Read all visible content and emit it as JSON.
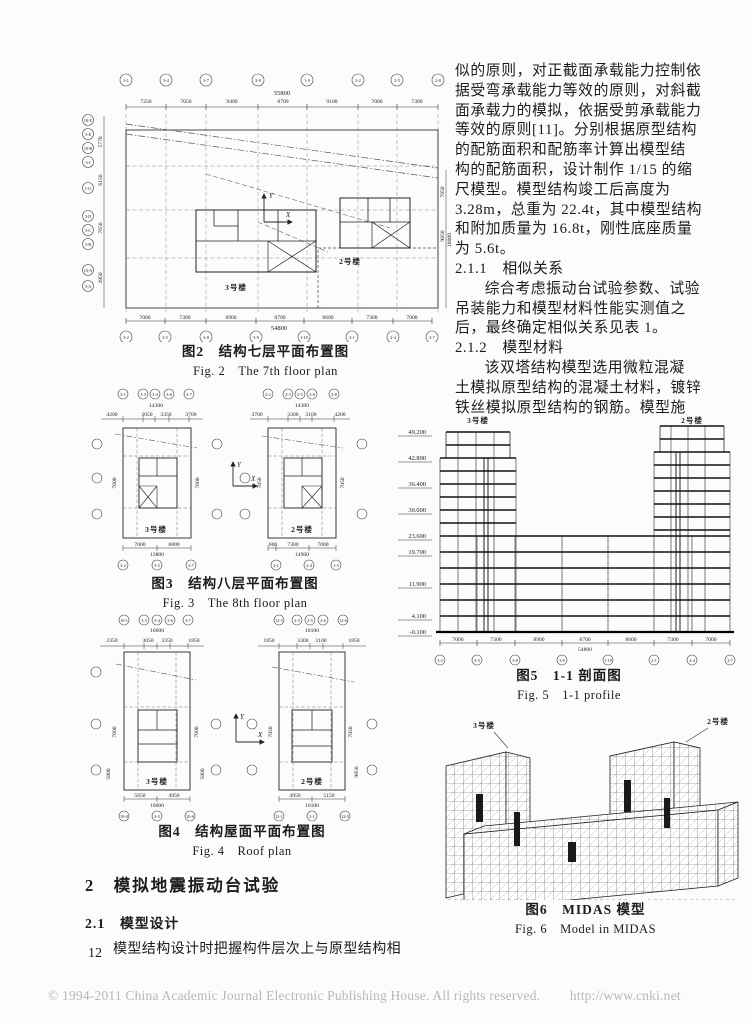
{
  "page": {
    "number": "12",
    "footer_text": "© 1994-2011 China Academic Journal Electronic Publishing House. All rights reserved.",
    "footer_url": "http://www.cnki.net"
  },
  "right_col": {
    "p1": [
      "似的原则，对正截面承载能力控制依",
      "据受弯承载能力等效的原则，对斜截",
      "面承载力的模拟，依据受剪承载能力",
      "等效的原则[11]。分别根据原型结构",
      "的配筋面积和配筋率计算出模型结",
      "构的配筋面积，设计制作 1/15 的缩",
      "尺模型。模型结构竣工后高度为",
      "3.28m，总重为 22.4t，其中模型结构",
      "和附加质量为 16.8t，刚性底座质量",
      "为 5.6t。"
    ],
    "h211": "2.1.1　相似关系",
    "p2": [
      "综合考虑振动台试验参数、试验",
      "吊装能力和模型材料性能实测值之",
      "后，最终确定相似关系见表 1。"
    ],
    "h212": "2.1.2　模型材料",
    "p3": [
      "该双塔结构模型选用微粒混凝",
      "土模拟原型结构的混凝土材料，镀锌",
      "铁丝模拟原型结构的钢筋。模型施"
    ]
  },
  "left_col": {
    "h2": "2　模拟地震振动台试验",
    "h21": "2.1　模型设计",
    "p1": "模型结构设计时把握构件层次上与原型结构相"
  },
  "fig2": {
    "caption_zh": "图2　结构七层平面布置图",
    "caption_en": "Fig. 2　The 7th floor plan",
    "top_total": "55800",
    "top_dims": [
      "7250",
      "7050",
      "9400",
      "8700",
      "9100",
      "7000",
      "7300"
    ],
    "bottom_dims": [
      "7000",
      "7300",
      "8900",
      "8700",
      "8600",
      "7300",
      "7000"
    ],
    "bottom_total": "54800",
    "top_bubbles": [
      "3-1",
      "3-4",
      "3-7",
      "3-8",
      "1-9",
      "2-2",
      "2-5",
      "2-8"
    ],
    "bottom_bubbles": [
      "3-2",
      "3-5",
      "3-8",
      "3-9",
      "1-10",
      "2-1",
      "2-4",
      "2-7"
    ],
    "left_bubbles": [
      "10-E",
      "3-E",
      "10-B",
      "3-J",
      "1-G",
      "3-D",
      "3-C",
      "3-B",
      "10-A",
      "3-A"
    ],
    "left_dims": [
      "5770",
      "6150",
      "7650",
      "3950"
    ],
    "right_dims": [
      "7050",
      "9850",
      "18000"
    ],
    "tower3": "3号楼",
    "tower2": "2号楼",
    "axis_x": "X",
    "axis_y": "Y"
  },
  "fig3": {
    "caption_zh": "图3　结构八层平面布置图",
    "caption_en": "Fig. 3　The 8th floor plan",
    "left": {
      "total": "14300",
      "dims": [
        "4200",
        "3050",
        "3350",
        "3700"
      ],
      "side": "7600",
      "bottom": [
        "7000",
        "6800"
      ],
      "bottom_total": "13800",
      "label": "3号楼",
      "bubbles": [
        "3-1",
        "3-3",
        "3-4",
        "3-6",
        "3-7"
      ],
      "bottom_bubbles": [
        "3-2",
        "3-5",
        "3-7"
      ]
    },
    "right": {
      "total": "14300",
      "dims": [
        "3700",
        "3300",
        "3100",
        "4200"
      ],
      "side": "7050",
      "bottom": [
        "600",
        "7300",
        "7000"
      ],
      "bottom_total": "14900",
      "label": "2号楼",
      "bubbles": [
        "2-2",
        "2-3",
        "2-5",
        "2-6",
        "2-8"
      ],
      "bottom_bubbles": [
        "2-1",
        "2-4",
        "1-3"
      ]
    },
    "axis_x": "X",
    "axis_y": "Y"
  },
  "fig4": {
    "caption_zh": "图4　结构屋面平面布置图",
    "caption_en": "Fig. 4　Roof plan",
    "left": {
      "total": "10600",
      "dims": [
        "2350",
        "3050",
        "3350",
        "1850"
      ],
      "side1": "7600",
      "side2": "5800",
      "bottom": [
        "5650",
        "4950"
      ],
      "bottom_total": "10600",
      "label": "3号楼",
      "bubbles": [
        "10-1",
        "3-3",
        "3-4",
        "3-6",
        "3-7"
      ],
      "bottom_bubbles": [
        "10-4",
        "3-5",
        "10-6"
      ]
    },
    "right": {
      "total": "10100",
      "dims": [
        "1850",
        "3300",
        "3100",
        "1850"
      ],
      "side1": "7050",
      "side2": "9850",
      "bottom": [
        "4950",
        "5150"
      ],
      "bottom_total": "10100",
      "label": "2号楼",
      "bubbles": [
        "12-3",
        "2-3",
        "2-5",
        "2-6",
        "12-6"
      ],
      "bottom_bubbles": [
        "12-1",
        "2-1",
        "12-5"
      ]
    },
    "axis_x": "X",
    "axis_y": "Y"
  },
  "fig5": {
    "caption_zh": "图5　1-1 剖面图",
    "caption_en": "Fig. 5　1-1 profile",
    "levels": [
      "49.200",
      "42.800",
      "36.400",
      "30.000",
      "23.600",
      "19.700",
      "11.900",
      "4.100",
      "-0.100"
    ],
    "tower3": "3号楼",
    "tower2": "2号楼",
    "dims": [
      "7000",
      "7300",
      "8900",
      "8700",
      "8600",
      "7300",
      "7000"
    ],
    "total": "54800",
    "bubbles": [
      "3-2",
      "3-5",
      "3-8",
      "3-9",
      "1-10",
      "2-1",
      "2-4",
      "2-7"
    ]
  },
  "fig6": {
    "caption_zh": "图6　MIDAS 模型",
    "caption_en": "Fig. 6　Model in MIDAS",
    "tower3": "3号楼",
    "tower2": "2号楼"
  }
}
